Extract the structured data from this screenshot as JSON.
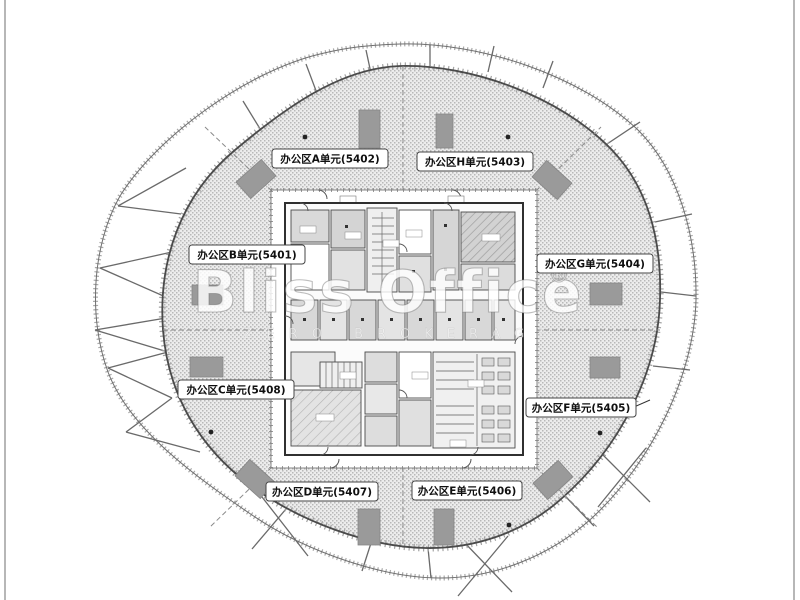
{
  "image": {
    "kind_label": "office-tower-floor-plan",
    "watermark": {
      "title": "Bliss Office",
      "registered_mark": "®",
      "tagline": "ZERO BROKERAGE"
    },
    "units": [
      {
        "id": "A",
        "label": "办公区A单元(5402)"
      },
      {
        "id": "H",
        "label": "办公区H单元(5403)"
      },
      {
        "id": "B",
        "label": "办公区B单元(5401)"
      },
      {
        "id": "G",
        "label": "办公区G单元(5404)"
      },
      {
        "id": "C",
        "label": "办公区C单元(5408)"
      },
      {
        "id": "F",
        "label": "办公区F单元(5405)"
      },
      {
        "id": "D",
        "label": "办公区D单元(5407)"
      },
      {
        "id": "E",
        "label": "办公区E单元(5406)"
      }
    ],
    "colors": {
      "hatch_dot": "#b8b8b8",
      "hatch_bg": "#ececec",
      "wall": "#3d3d3d",
      "shaft_gray": "#9a9a9a",
      "frame_line": "#b7b7b7",
      "brace": "#6a6a6a"
    }
  }
}
